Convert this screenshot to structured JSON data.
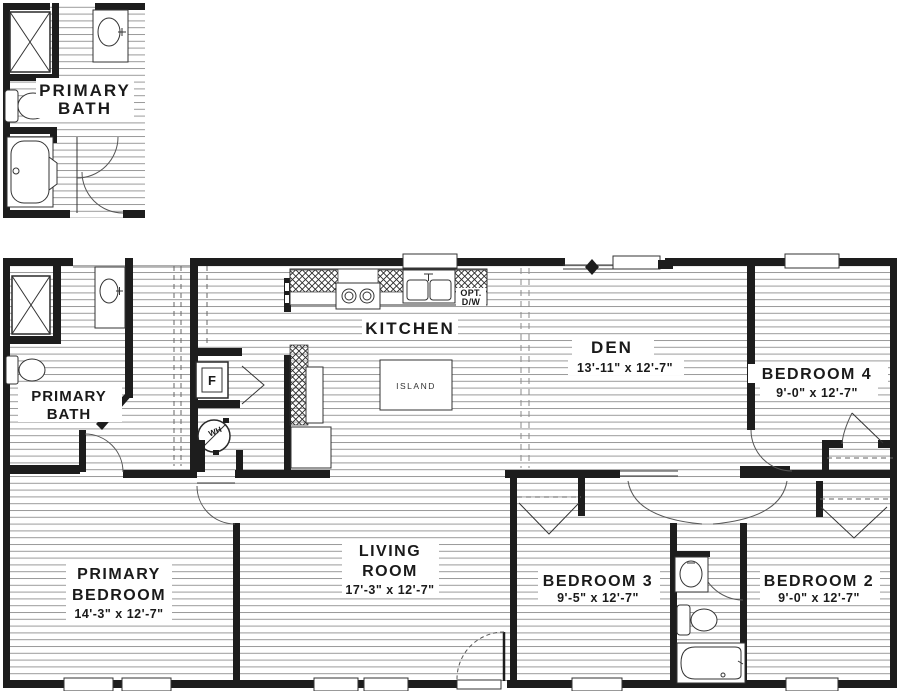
{
  "plan_title": "floor plan",
  "inset": {
    "line1": "PRIMARY",
    "line2": "BATH"
  },
  "rooms": {
    "primary_bath": {
      "line1": "PRIMARY",
      "line2": "BATH"
    },
    "kitchen": {
      "name": "KITCHEN"
    },
    "den": {
      "name": "DEN",
      "dims": "13'-11\" x  12'-7\""
    },
    "bedroom_4": {
      "name": "BEDROOM 4",
      "dims": "9'-0\" x  12'-7\""
    },
    "primary_bedroom": {
      "line1": "PRIMARY",
      "line2": "BEDROOM",
      "dims": "14'-3\" x  12'-7\""
    },
    "living_room": {
      "line1": "LIVING",
      "line2": "ROOM",
      "dims": "17'-3\" x  12'-7\""
    },
    "bedroom_3": {
      "name": "BEDROOM 3",
      "dims": "9'-5\" x  12'-7\""
    },
    "bedroom_2": {
      "name": "BEDROOM 2",
      "dims": "9'-0\" x  12'-7\""
    }
  },
  "fixtures": {
    "island_label": "ISLAND",
    "furnace_label": "F",
    "water_heater_label": "WH",
    "opt_dishwasher_line1": "OPT.",
    "opt_dishwasher_line2": "D/W"
  },
  "colors": {
    "wall": "#1d1d1d",
    "floor_line": "#9a9a9a",
    "background": "#ffffff"
  }
}
